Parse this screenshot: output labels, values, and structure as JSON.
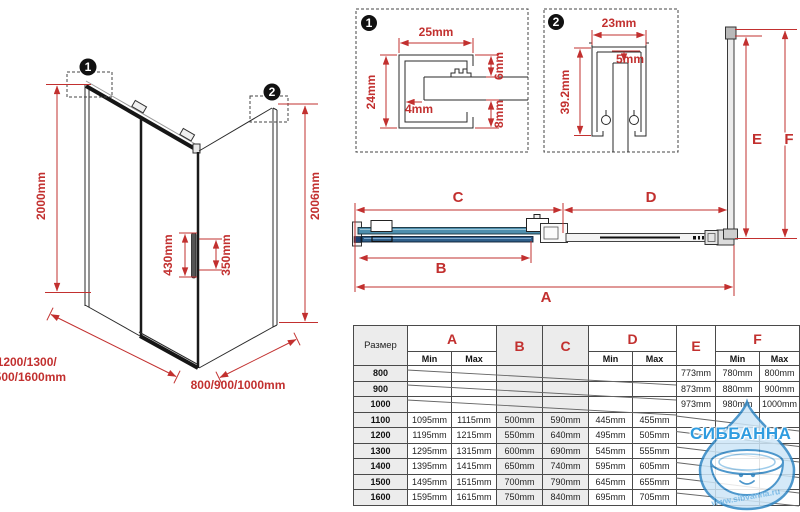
{
  "iso": {
    "badge1": "1",
    "badge2": "2",
    "height_left": "2000mm",
    "height_right": "2006mm",
    "handle_height": "430mm",
    "handle_inner": "350mm",
    "width_line1": "1100/1200/1300/",
    "width_line2": "1400/1500/1600mm",
    "depth": "800/900/1000mm"
  },
  "detail1": {
    "badge": "1",
    "width": "25mm",
    "height": "24mm",
    "gap_top": "6mm",
    "wall": "4mm",
    "gap_bottom": "8mm"
  },
  "detail2": {
    "badge": "2",
    "width": "23mm",
    "gap": "5mm",
    "height": "39.2mm"
  },
  "section": {
    "a": "A",
    "b": "B",
    "c": "C",
    "d": "D",
    "e": "E",
    "f": "F"
  },
  "table": {
    "size_label": "Размер",
    "min_label": "Min",
    "max_label": "Max",
    "rows": [
      [
        "800",
        "",
        "",
        "",
        "",
        "",
        "",
        "773mm",
        "780mm",
        "800mm"
      ],
      [
        "900",
        "",
        "",
        "",
        "",
        "",
        "",
        "873mm",
        "880mm",
        "900mm"
      ],
      [
        "1000",
        "",
        "",
        "",
        "",
        "",
        "",
        "973mm",
        "980mm",
        "1000mm"
      ],
      [
        "1100",
        "1095mm",
        "1115mm",
        "500mm",
        "590mm",
        "445mm",
        "455mm",
        "",
        "",
        ""
      ],
      [
        "1200",
        "1195mm",
        "1215mm",
        "550mm",
        "640mm",
        "495mm",
        "505mm",
        "",
        "",
        ""
      ],
      [
        "1300",
        "1295mm",
        "1315mm",
        "600mm",
        "690mm",
        "545mm",
        "555mm",
        "",
        "",
        ""
      ],
      [
        "1400",
        "1395mm",
        "1415mm",
        "650mm",
        "740mm",
        "595mm",
        "605mm",
        "",
        "",
        ""
      ],
      [
        "1500",
        "1495mm",
        "1515mm",
        "700mm",
        "790mm",
        "645mm",
        "655mm",
        "",
        "",
        ""
      ],
      [
        "1600",
        "1595mm",
        "1615mm",
        "750mm",
        "840mm",
        "695mm",
        "705mm",
        "",
        "",
        ""
      ]
    ]
  },
  "watermark": {
    "title": "СИББАННА",
    "url": "www.sibvanna.ru"
  },
  "colors": {
    "dimension_red": "#c2302f",
    "glass_teal": "#4e8fae",
    "glass_navy": "#2e5f8a",
    "watermark_blue": "#2f9ce0"
  }
}
